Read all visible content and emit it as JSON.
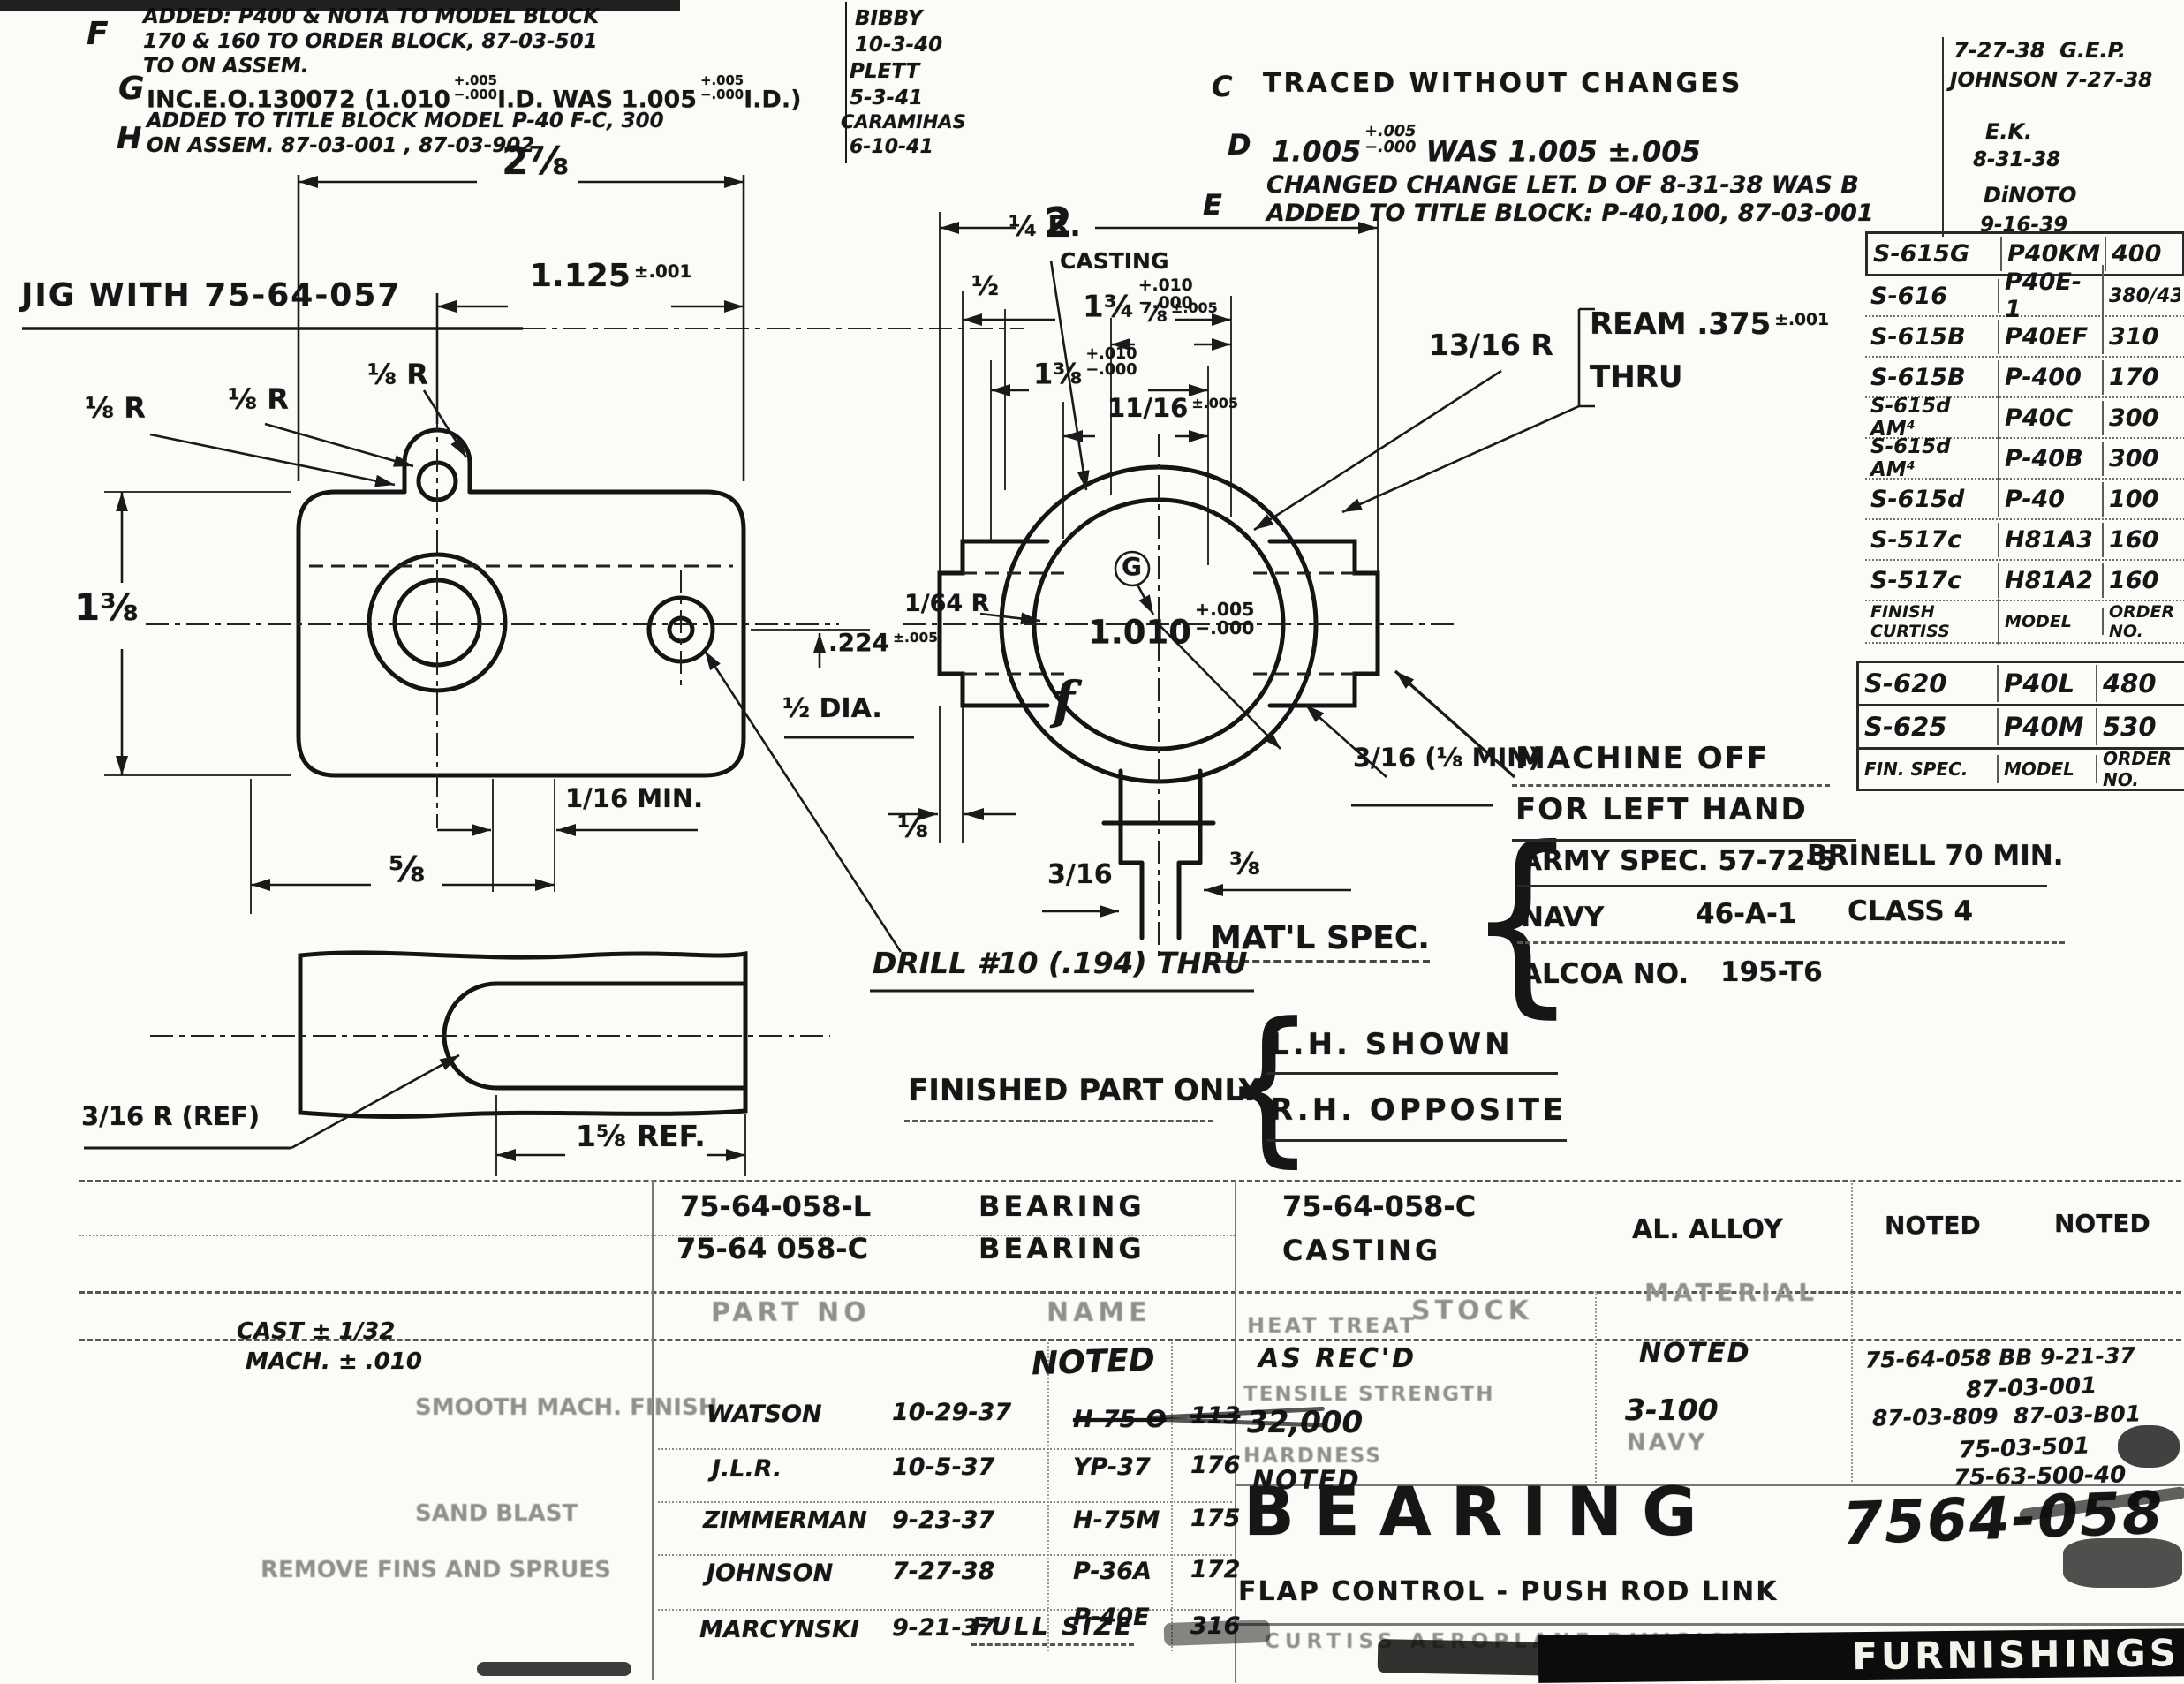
{
  "rev_left": {
    "f_letter": "F",
    "f_line1": "ADDED: P400 & NOTA TO MODEL BLOCK",
    "f_line2": "170 & 160 TO ORDER BLOCK, 87-03-501",
    "f_line3": "TO ON ASSEM.",
    "f_by": "BIBBY",
    "f_date": "10-3-40",
    "g_letter": "G",
    "g_line": "INC.E.O.130072 (1.010",
    "g_tol1": "+.005\n−.000",
    "g_mid": "I.D. WAS 1.005",
    "g_tol2": "+.005\n−.000",
    "g_end": "I.D.)",
    "g_by": "PLETT",
    "g_date": "5-3-41",
    "h_letter": "H",
    "h_line1": "ADDED TO TITLE BLOCK MODEL P-40 F-C, 300",
    "h_line2": "ON ASSEM. 87-03-001 , 87-03-902",
    "h_by": "CARAMIHAS",
    "h_date": "6-10-41"
  },
  "rev_right": {
    "c_letter": "C",
    "c_text": "TRACED WITHOUT CHANGES",
    "c_by1": "7-27-38  G.E.P.",
    "c_by2": "JOHNSON 7-27-38",
    "d_letter": "D",
    "d_val1": "1.005",
    "d_tol": "+.005\n−.000",
    "d_val2": " WAS 1.005 ±.005",
    "d_by1": "E.K.",
    "d_by2": "8-31-38",
    "e_letter": "E",
    "e_line1": "CHANGED CHANGE LET. D OF 8-31-38 WAS B",
    "e_line2": "ADDED TO TITLE BLOCK: P-40,100, 87-03-001",
    "e_by1": "DiNOTO",
    "e_by2": "9-16-39"
  },
  "model_table": {
    "rows": [
      {
        "model": "S-615G",
        "plane": "P40KM",
        "order": "400"
      },
      {
        "model": "S-616",
        "plane": "P40E-1",
        "order": "380/430"
      },
      {
        "model": "S-615B",
        "plane": "P40EF",
        "order": "310"
      },
      {
        "model": "S-615B",
        "plane": "P-400",
        "order": "170"
      },
      {
        "model": "S-615d AM⁴",
        "plane": "P40C",
        "order": "300"
      },
      {
        "model": "S-615d AM⁴",
        "plane": "P-40B",
        "order": "300"
      },
      {
        "model": "S-615d",
        "plane": "P-40",
        "order": "100"
      },
      {
        "model": "S-517c",
        "plane": "H81A3",
        "order": "160"
      },
      {
        "model": "S-517c",
        "plane": "H81A2",
        "order": "160"
      }
    ],
    "footer": {
      "model": "FINISH CURTISS",
      "plane": "MODEL",
      "order": "ORDER NO."
    }
  },
  "finish_table": {
    "rows": [
      {
        "spec": "S-620",
        "plane": "P40L",
        "order": "480"
      },
      {
        "spec": "S-625",
        "plane": "P40M",
        "order": "530"
      }
    ],
    "footer": {
      "spec": "FIN. SPEC.",
      "plane": "MODEL",
      "order": "ORDER NO."
    }
  },
  "matl_spec": {
    "label": "MAT'L SPEC.",
    "brace": "{",
    "row1_a": "ARMY SPEC. 57-72-5",
    "row1_b": "BRINELL 70 MIN.",
    "row2_a": "NAVY",
    "row2_b": "46-A-1",
    "row2_c": "CLASS 4",
    "row3_a": "ALCOA NO.",
    "row3_b": "195-T6"
  },
  "finished_part": {
    "label": "FINISHED PART ONLY",
    "brace": "{",
    "line1": "L.H. SHOWN",
    "line2": "R.H. OPPOSITE"
  },
  "notes": {
    "jig": "JIG WITH 75-64-057",
    "drill": "DRILL #10 (.194) THRU",
    "ream1": "REAM .375",
    "ream_tol": "±.001",
    "ream2": "THRU",
    "machine1": "MACHINE OFF",
    "machine2": "FOR LEFT HAND"
  },
  "dims": {
    "d278": "2⅞",
    "d1125": "1.125",
    "d1125_tol": "±.001",
    "r18a": "⅛ R",
    "r18b": "⅛ R",
    "r18c": "⅛ R",
    "d138": "1⅜",
    "d224": ".224",
    "d224_tol": "±.005",
    "dhalf_dia": "½ DIA.",
    "d116min": "1/16 MIN.",
    "d58": "⅝",
    "d316ref": "3/16 R (REF)",
    "d158ref": "1⅝ REF.",
    "d2": "2",
    "casting": "CASTING",
    "d134": "1¾",
    "d134_tol": "+.010\n−.000",
    "d78": "⅞",
    "d78_tol": "±.005",
    "d138c": "1⅜",
    "d138c_tol": "+.010\n−.000",
    "d1116": "11/16",
    "d1116_tol": "±.005",
    "r14": "¼ R.",
    "dhalf": "½",
    "r1316": "13/16 R",
    "g": "G",
    "d1010": "1.010",
    "d1010_tol": "+.005\n−.000",
    "r164": "1/64 R",
    "f": "f",
    "d316min": "3/16 (⅛ MIN)",
    "d18": "⅛",
    "d316": "3/16",
    "d38": "⅜"
  },
  "title_block": {
    "part1_no": "75-64-058-L",
    "part1_name": "BEARING",
    "part2_no": "75-64 058-C",
    "part2_name": "BEARING",
    "stock_no": "75-64-058-C",
    "stock_name": "CASTING",
    "material": "AL. ALLOY",
    "finish1": "NOTED",
    "finish2": "NOTED",
    "h_part": "PART NO",
    "h_name": "NAME",
    "h_stock": "STOCK",
    "h_material": "MATERIAL",
    "tol1": "CAST ± 1/32",
    "tol2": "MACH. ± .010",
    "faint1": "SMOOTH MACH. FINISH",
    "faint2": "SAND BLAST",
    "faint3": "REMOVE FINS AND SPRUES",
    "noted": "NOTED",
    "sig1_name": "WATSON",
    "sig1_date": "10-29-37",
    "sig1_model": "H-75-O",
    "sig1_order": "113",
    "sig2_name": "J.L.R.",
    "sig2_date": "10-5-37",
    "sig2_model": "YP-37",
    "sig2_order": "176",
    "sig3_name": "ZIMMERMAN",
    "sig3_date": "9-23-37",
    "sig3_model": "H-75M",
    "sig3_order": "175",
    "sig4_name": "JOHNSON",
    "sig4_date": "7-27-38",
    "sig4_model": "P-36A",
    "sig4_order": "172",
    "sig5_name": "MARCYNSKI",
    "sig5_date": "9-21-37",
    "sig5_model": "P-40E",
    "sig5_order": "316",
    "heat_label": "HEAT TREAT",
    "heat_value": "AS REC'D",
    "tensile_label": "TENSILE STRENGTH",
    "tensile_value": "32,000",
    "hardness_label": "HARDNESS",
    "hardness_value": "NOTED",
    "mid_noted": "NOTED",
    "mid_value": "3-100",
    "mid_navy": "NAVY",
    "scr1": "75-64-058 BB 9-21-37",
    "scr2": "87-03-001",
    "scr3": "87-03-809  87-03-B01",
    "scr4": "75-03-501",
    "scr5": "75-63-500-40",
    "title": "BEARING",
    "subtitle": "FLAP CONTROL - PUSH ROD LINK",
    "drawing_no": "7564-058",
    "scale": "FULL SIZE",
    "company": "CURTISS AEROPLANE DIVISION  CURTISS-WRIGHT",
    "stamp": "FURNISHINGS"
  }
}
